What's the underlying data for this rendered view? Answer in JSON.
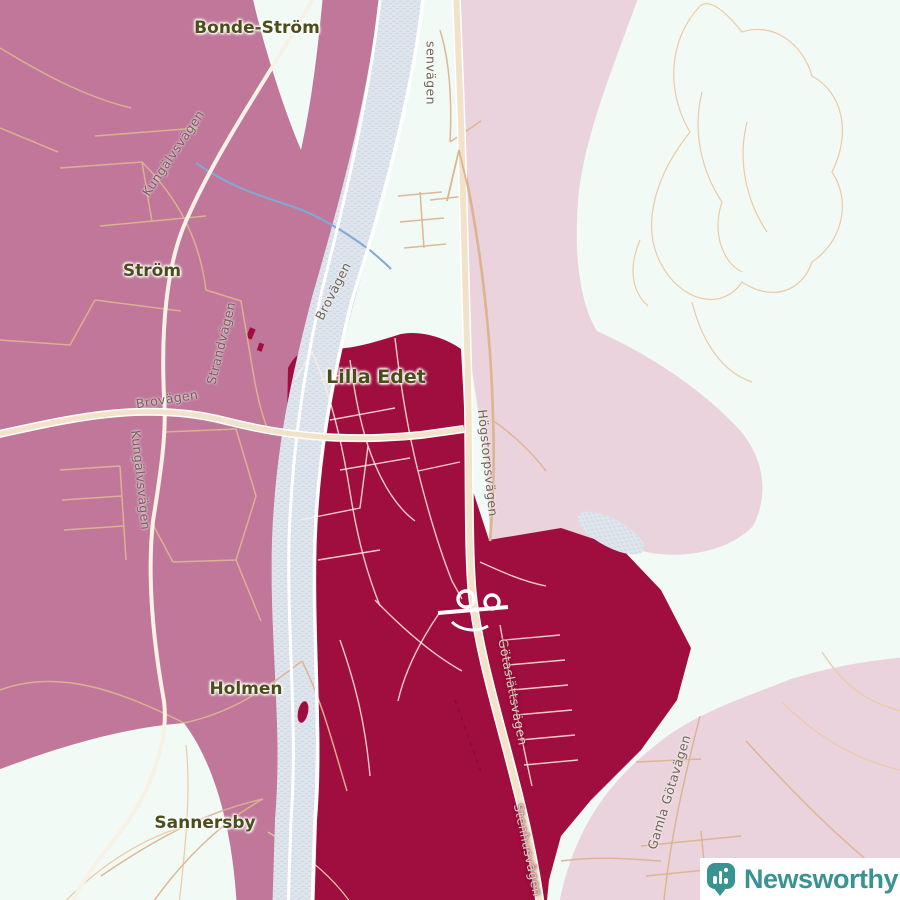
{
  "map": {
    "place_labels": [
      {
        "id": "bonde-strom",
        "text": "Bonde-Ström"
      },
      {
        "id": "strom",
        "text": "Ström"
      },
      {
        "id": "lilla-edet",
        "text": "Lilla Edet"
      },
      {
        "id": "holmen",
        "text": "Holmen"
      },
      {
        "id": "sannersby",
        "text": "Sannersby"
      }
    ],
    "road_labels": [
      {
        "id": "skansenvagen-partial",
        "text": "senvägen"
      },
      {
        "id": "kungalvsvagen-north",
        "text": "Kungälvsvägen"
      },
      {
        "id": "brovagen-east",
        "text": "Brovägen"
      },
      {
        "id": "strandvagen",
        "text": "Strandvägen"
      },
      {
        "id": "brovagen-west",
        "text": "Brovägen"
      },
      {
        "id": "kungalvsvagen-south",
        "text": "Kungälvsvägen"
      },
      {
        "id": "hogstorpsvagen",
        "text": "Högstorpsvägen"
      },
      {
        "id": "gotaslattsvagen",
        "text": "Götaslättsvägen"
      },
      {
        "id": "stenhusvagen",
        "text": "Stenhusvägen"
      },
      {
        "id": "gamla-gotavagen",
        "text": "Gamla Götavägen"
      }
    ],
    "regions": [
      {
        "id": "selected-area-dark",
        "label": "Lilla Edet tätort",
        "color": "#a00d3f"
      },
      {
        "id": "surrounding-area-medium",
        "label": "west bank area",
        "color": "#c0779a"
      },
      {
        "id": "surrounding-area-light",
        "label": "east bank area",
        "color": "#ead3dc"
      }
    ],
    "colors": {
      "background": "#f2faf6",
      "water": "#dfe5ed",
      "minor_road": "#ddb48f",
      "highway_fill": "#f2e2c9",
      "stream": "#84a8d6",
      "place_label": "#4c4e1a",
      "road_label": "#6e6355",
      "brand_teal": "#3a9393"
    },
    "logo": {
      "brand": "Newsworthy",
      "icon": "newsworthy-bar-chart-bubble-icon"
    }
  }
}
